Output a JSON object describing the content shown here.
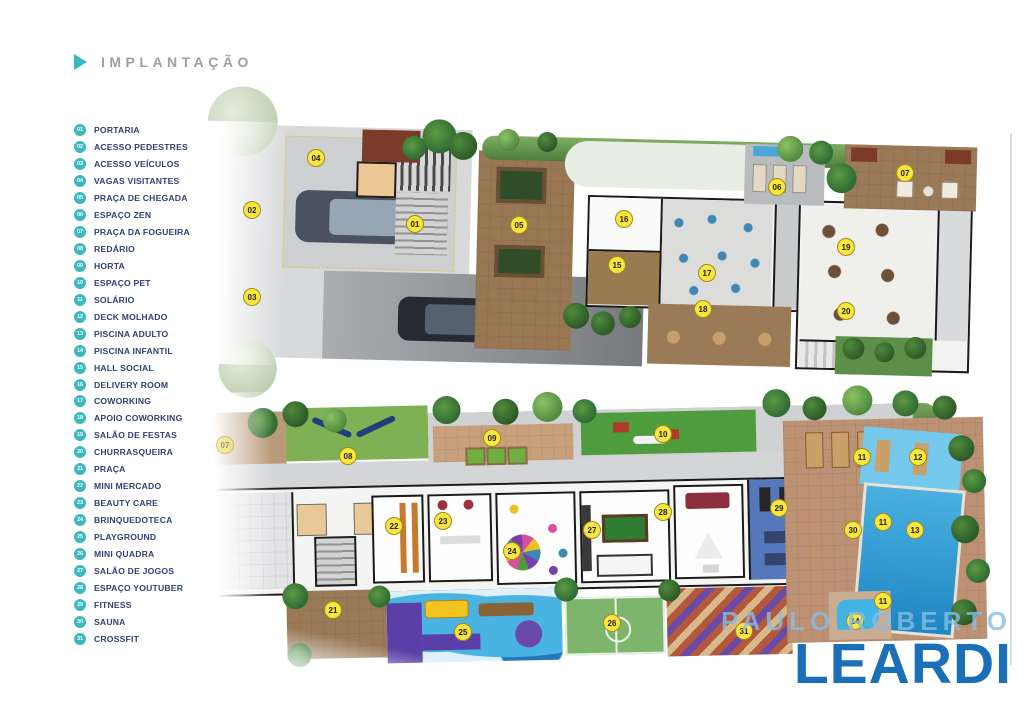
{
  "header": {
    "title": "IMPLANTAÇÃO"
  },
  "legend": {
    "items": [
      {
        "num": "01",
        "label": "PORTARIA"
      },
      {
        "num": "02",
        "label": "ACESSO PEDESTRES"
      },
      {
        "num": "03",
        "label": "ACESSO VEÍCULOS"
      },
      {
        "num": "04",
        "label": "VAGAS VISITANTES"
      },
      {
        "num": "05",
        "label": "PRAÇA DE CHEGADA"
      },
      {
        "num": "06",
        "label": "ESPAÇO ZEN"
      },
      {
        "num": "07",
        "label": "PRAÇA DA FOGUEIRA"
      },
      {
        "num": "08",
        "label": "REDÁRIO"
      },
      {
        "num": "09",
        "label": "HORTA"
      },
      {
        "num": "10",
        "label": "ESPAÇO PET"
      },
      {
        "num": "11",
        "label": "SOLÁRIO"
      },
      {
        "num": "12",
        "label": "DECK MOLHADO"
      },
      {
        "num": "13",
        "label": "PISCINA ADULTO"
      },
      {
        "num": "14",
        "label": "PISCINA INFANTIL"
      },
      {
        "num": "15",
        "label": "HALL SOCIAL"
      },
      {
        "num": "16",
        "label": "DELIVERY ROOM"
      },
      {
        "num": "17",
        "label": "COWORKING"
      },
      {
        "num": "18",
        "label": "APOIO COWORKING"
      },
      {
        "num": "19",
        "label": "SALÃO DE FESTAS"
      },
      {
        "num": "20",
        "label": "CHURRASQUEIRA"
      },
      {
        "num": "21",
        "label": "PRAÇA"
      },
      {
        "num": "22",
        "label": "MINI MERCADO"
      },
      {
        "num": "23",
        "label": "BEAUTY CARE"
      },
      {
        "num": "24",
        "label": "BRINQUEDOTECA"
      },
      {
        "num": "25",
        "label": "PLAYGROUND"
      },
      {
        "num": "26",
        "label": "MINI QUADRA"
      },
      {
        "num": "27",
        "label": "SALÃO DE JOGOS"
      },
      {
        "num": "28",
        "label": "ESPAÇO YOUTUBER"
      },
      {
        "num": "29",
        "label": "FITNESS"
      },
      {
        "num": "30",
        "label": "SAUNA"
      },
      {
        "num": "31",
        "label": "CROSSFIT"
      }
    ]
  },
  "markers": [
    {
      "plan": "top",
      "num": "01",
      "x": 415,
      "y": 224
    },
    {
      "plan": "top",
      "num": "02",
      "x": 252,
      "y": 210
    },
    {
      "plan": "top",
      "num": "03",
      "x": 252,
      "y": 297
    },
    {
      "plan": "top",
      "num": "04",
      "x": 316,
      "y": 158
    },
    {
      "plan": "top",
      "num": "05",
      "x": 519,
      "y": 225
    },
    {
      "plan": "top",
      "num": "06",
      "x": 777,
      "y": 187
    },
    {
      "plan": "top",
      "num": "07",
      "x": 905,
      "y": 173
    },
    {
      "plan": "top",
      "num": "15",
      "x": 617,
      "y": 265
    },
    {
      "plan": "top",
      "num": "16",
      "x": 624,
      "y": 219
    },
    {
      "plan": "top",
      "num": "17",
      "x": 707,
      "y": 273
    },
    {
      "plan": "top",
      "num": "18",
      "x": 703,
      "y": 309
    },
    {
      "plan": "top",
      "num": "19",
      "x": 846,
      "y": 247
    },
    {
      "plan": "top",
      "num": "20",
      "x": 846,
      "y": 311
    },
    {
      "plan": "bottom",
      "num": "07",
      "x": 225,
      "y": 445,
      "faded": true
    },
    {
      "plan": "bottom",
      "num": "08",
      "x": 348,
      "y": 456
    },
    {
      "plan": "bottom",
      "num": "09",
      "x": 492,
      "y": 438
    },
    {
      "plan": "bottom",
      "num": "10",
      "x": 663,
      "y": 434
    },
    {
      "plan": "bottom",
      "num": "11",
      "x": 862,
      "y": 457
    },
    {
      "plan": "bottom",
      "num": "12",
      "x": 918,
      "y": 457
    },
    {
      "plan": "bottom",
      "num": "11",
      "x": 883,
      "y": 522
    },
    {
      "plan": "bottom",
      "num": "13",
      "x": 915,
      "y": 530
    },
    {
      "plan": "bottom",
      "num": "14",
      "x": 855,
      "y": 621
    },
    {
      "plan": "bottom",
      "num": "11",
      "x": 883,
      "y": 601
    },
    {
      "plan": "bottom",
      "num": "21",
      "x": 333,
      "y": 610
    },
    {
      "plan": "bottom",
      "num": "22",
      "x": 394,
      "y": 526
    },
    {
      "plan": "bottom",
      "num": "23",
      "x": 443,
      "y": 521
    },
    {
      "plan": "bottom",
      "num": "24",
      "x": 512,
      "y": 551
    },
    {
      "plan": "bottom",
      "num": "25",
      "x": 463,
      "y": 632
    },
    {
      "plan": "bottom",
      "num": "26",
      "x": 612,
      "y": 623
    },
    {
      "plan": "bottom",
      "num": "27",
      "x": 592,
      "y": 530
    },
    {
      "plan": "bottom",
      "num": "28",
      "x": 663,
      "y": 512
    },
    {
      "plan": "bottom",
      "num": "29",
      "x": 779,
      "y": 508
    },
    {
      "plan": "bottom",
      "num": "30",
      "x": 853,
      "y": 530
    },
    {
      "plan": "bottom",
      "num": "31",
      "x": 744,
      "y": 631
    }
  ],
  "watermark": {
    "line1": "PAULO ROBERTO",
    "line2": "LEARDI"
  },
  "colors": {
    "accent_teal": "#3cb8bf",
    "legend_text": "#2e4172",
    "title_gray": "#9aa0a4",
    "marker_fill": "#f9e63c",
    "marker_border": "#a08c1c",
    "marker_text": "#1c1c1c",
    "watermark_light": "rgba(136,188,229,.8)",
    "watermark_blue": "#1b6fb8"
  }
}
